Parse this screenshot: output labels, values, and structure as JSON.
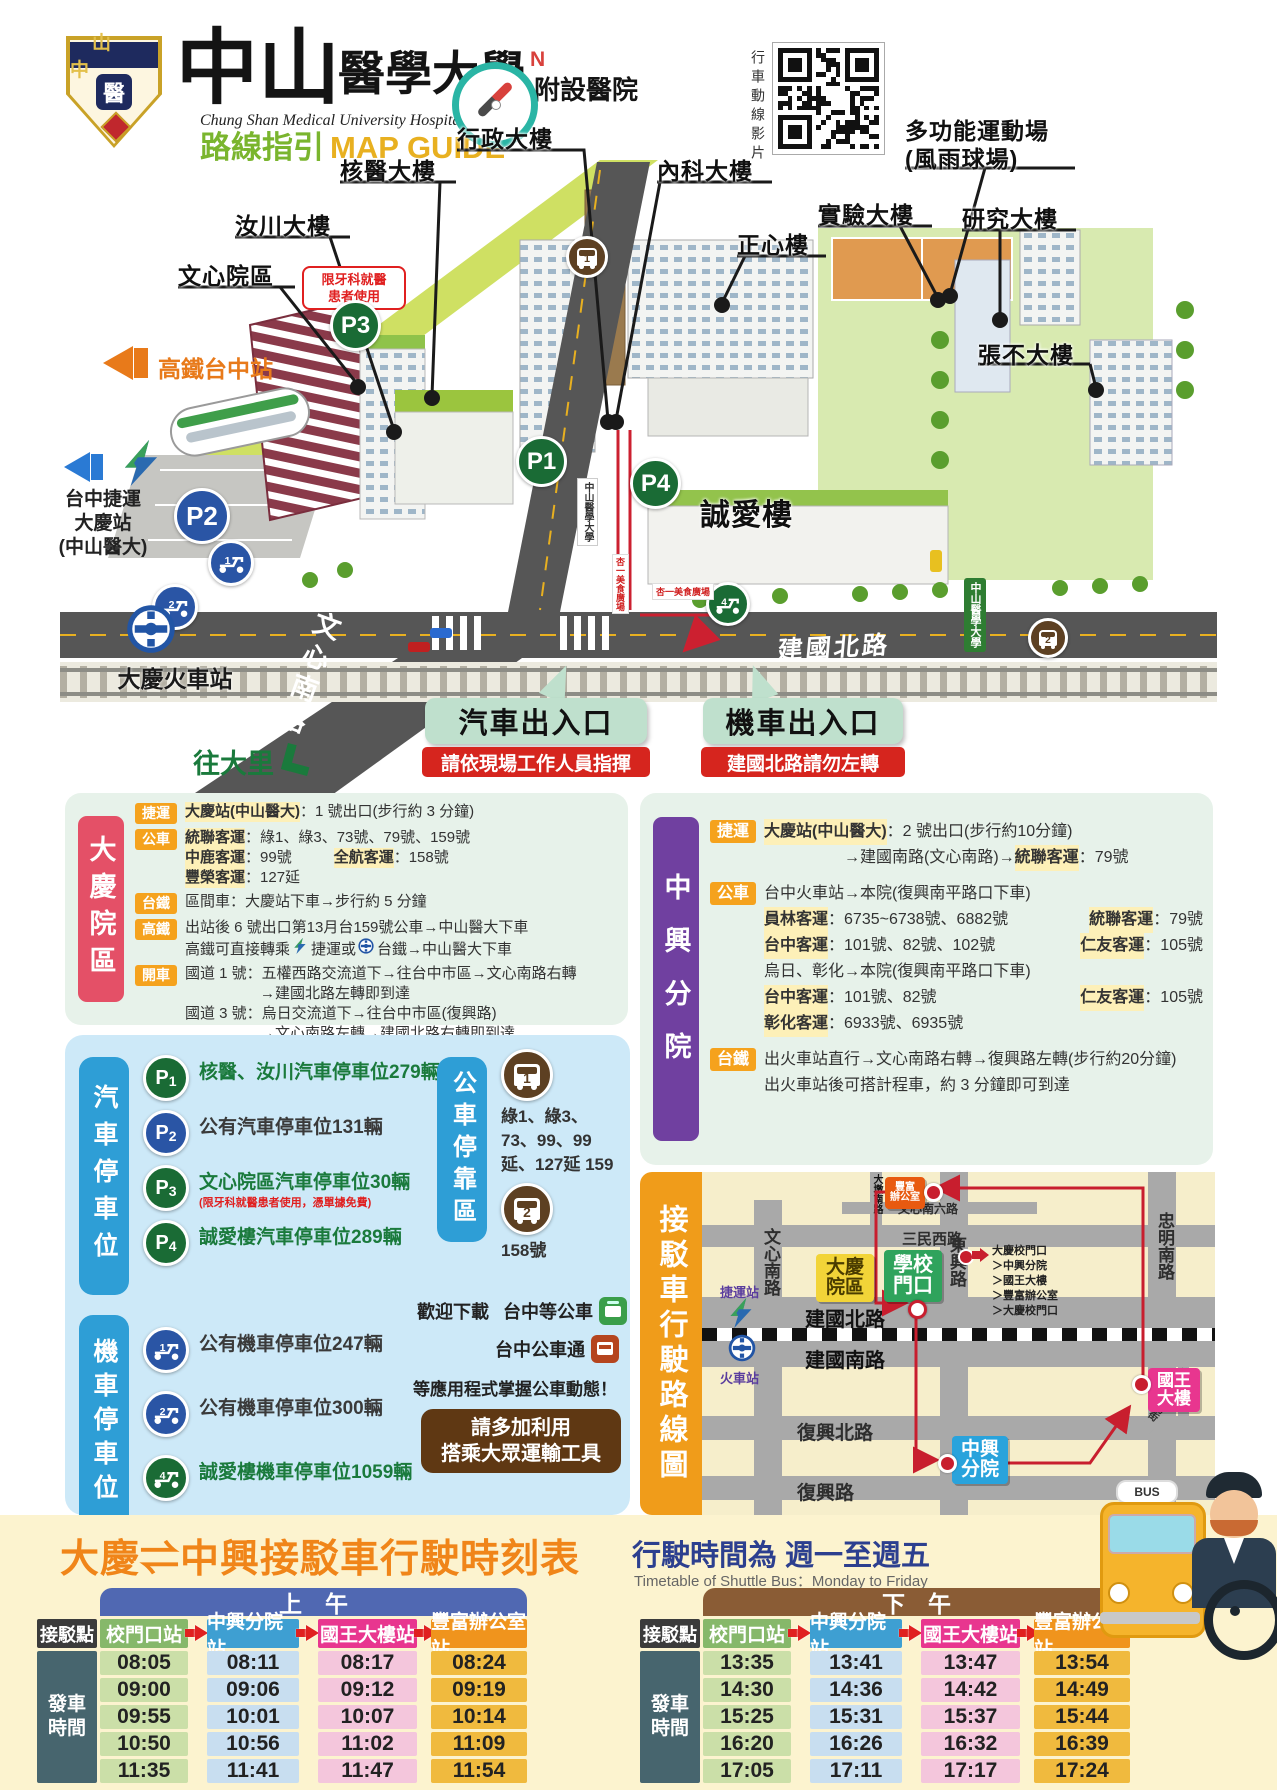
{
  "header": {
    "badge_text": "山中",
    "badge_emblem": "醫",
    "title_zh_main": "中山",
    "title_zh_rest": "醫學大學",
    "title_zh_suffix": "附設醫院",
    "title_en": "Chung Shan Medical University Hospital",
    "guide_zh": "路線指引",
    "guide_en": "MAP GUIDE",
    "compass_n": "N",
    "qr_caption": "行車動線影片"
  },
  "map": {
    "buildings": {
      "admin": "行政大樓",
      "nuclear": "核醫大樓",
      "internal": "內科大樓",
      "zhengxin": "正心樓",
      "lab": "實驗大樓",
      "research": "研究大樓",
      "sports1": "多功能運動場",
      "sports2": "(風雨球場)",
      "zhangbu": "張不大樓",
      "ruchuan": "汝川大樓",
      "wenxin": "文心院區",
      "chengai": "誠愛樓"
    },
    "dental_note1": "限牙科就醫",
    "dental_note2": "患者使用",
    "markers": {
      "p1": "P1",
      "p2": "P2",
      "p3": "P3",
      "p4": "P4",
      "m1": "1",
      "m2": "2",
      "m4": "4",
      "bus1": "1",
      "bus2": "2"
    },
    "hsr_station": "高鐵台中站",
    "mrt_line1": "台中捷運",
    "mrt_line2": "大慶站",
    "mrt_line3": "(中山醫大)",
    "tra_station": "大慶火車站",
    "road_wenxin": "文心南路",
    "road_jianguo": "建國北路",
    "to_dali": "往大里",
    "campus_sign": "中山醫學大學",
    "food_court": "杏一美食廣場",
    "car_entrance": "汽車出入口",
    "car_entrance_note": "請依現場工作人員指揮",
    "moto_entrance": "機車出入口",
    "moto_entrance_note": "建國北路請勿左轉"
  },
  "daqing_box": {
    "title": "大慶院區",
    "rows": [
      {
        "tag": "捷運",
        "lines": [
          [
            {
              "t": "大慶站(中山醫大)",
              "hl": 1
            },
            {
              "t": "：1 號出口(步行約 3 分鐘)"
            }
          ]
        ]
      },
      {
        "tag": "公車",
        "lines": [
          [
            {
              "t": "統聯客運",
              "hl": 1
            },
            {
              "t": "：綠1、綠3、73號、79號、159號"
            }
          ],
          [
            {
              "t": "中鹿客運",
              "hl": 1
            },
            {
              "t": "：99號"
            },
            {
              "t": "全航客運",
              "hl": 1,
              "gap": 1
            },
            {
              "t": "：158號"
            }
          ],
          [
            {
              "t": "豐榮客運",
              "hl": 1
            },
            {
              "t": "：127延"
            }
          ]
        ]
      },
      {
        "tag": "台鐵",
        "lines": [
          [
            {
              "t": "區間車：大慶站下車→步行約 5 分鐘"
            }
          ]
        ]
      },
      {
        "tag": "高鐵",
        "lines": [
          [
            {
              "t": "出站後 6 號出口第13月台159號公車→中山醫大下車"
            }
          ],
          [
            {
              "t": "高鐵可直接轉乘"
            },
            {
              "icon": "mrt"
            },
            {
              "t": "捷運或"
            },
            {
              "icon": "tra"
            },
            {
              "t": "台鐵→中山醫大下車"
            }
          ]
        ]
      },
      {
        "tag": "開車",
        "lines": [
          [
            {
              "t": "國道 1 號：五權西路交流道下→往台中市區→文心南路右轉"
            }
          ],
          [
            {
              "t": "　　　　　→建國北路左轉即到達"
            }
          ],
          [
            {
              "t": "國道 3 號：烏日交流道下→往台中市區(復興路)"
            }
          ],
          [
            {
              "t": "　　　　　→文心南路左轉→建國北路右轉即到達"
            }
          ]
        ]
      }
    ]
  },
  "zhongxing_box": {
    "title": "中興分院",
    "rows": [
      {
        "tag": "捷運",
        "lines": [
          [
            {
              "t": "大慶站(中山醫大)",
              "hl": 1
            },
            {
              "t": "：2 號出口(步行約10分鐘)"
            }
          ],
          [
            {
              "t": "　　　　　→建國南路(文心南路)→"
            },
            {
              "t": "統聯客運",
              "hl": 1
            },
            {
              "t": "：79號"
            }
          ]
        ]
      },
      {
        "tag": "公車",
        "lines": [
          [
            {
              "t": "台中火車站→本院(復興南平路口下車)"
            }
          ],
          [
            {
              "t": "員林客運",
              "hl": 1
            },
            {
              "t": "：6735~6738號、6882號"
            },
            {
              "t": "統聯客運",
              "hl": 1,
              "right": 1
            },
            {
              "t": "：79號"
            }
          ],
          [
            {
              "t": "台中客運",
              "hl": 1
            },
            {
              "t": "：101號、82號、102號"
            },
            {
              "t": "仁友客運",
              "hl": 1,
              "right": 1
            },
            {
              "t": "：105號"
            }
          ],
          [
            {
              "t": "烏日、彰化→本院(復興南平路口下車)"
            }
          ],
          [
            {
              "t": "台中客運",
              "hl": 1
            },
            {
              "t": "：101號、82號"
            },
            {
              "t": "仁友客運",
              "hl": 1,
              "right": 1
            },
            {
              "t": "：105號"
            }
          ],
          [
            {
              "t": "彰化客運",
              "hl": 1
            },
            {
              "t": "：6933號、6935號"
            }
          ]
        ]
      },
      {
        "tag": "台鐵",
        "lines": [
          [
            {
              "t": "出火車站直行→文心南路右轉→復興路左轉(步行約20分鐘)"
            }
          ],
          [
            {
              "t": "出火車站後可搭計程車，約 3 分鐘即可到達"
            }
          ]
        ]
      }
    ]
  },
  "parking": {
    "car_label": "汽車停車位",
    "moto_label": "機車停車位",
    "bus_label": "公車停靠區",
    "car_items": [
      {
        "n": "1",
        "c": "g",
        "t": "核醫、汝川汽車停車位279輛"
      },
      {
        "n": "2",
        "c": "b",
        "t": "公有汽車停車位131輛"
      },
      {
        "n": "3",
        "c": "g",
        "t": "文心院區汽車停車位30輛",
        "note": "(限牙科就醫患者使用，憑單據免費)"
      },
      {
        "n": "4",
        "c": "g",
        "t": "誠愛樓汽車停車位289輛"
      }
    ],
    "moto_items": [
      {
        "n": "1",
        "c": "b",
        "t": "公有機車停車位247輛"
      },
      {
        "n": "2",
        "c": "b",
        "t": "公有機車停車位300輛"
      },
      {
        "n": "4",
        "c": "g",
        "t": "誠愛樓機車停車位1059輛"
      }
    ],
    "bus_stops": [
      {
        "n": "1",
        "routes": "綠1、綠3、73、99、99延、127延 159"
      },
      {
        "n": "2",
        "routes": "158號"
      }
    ],
    "dl_prefix": "歡迎下載",
    "apps": [
      "台中等公車",
      "台中公車通"
    ],
    "dl_suffix": "等應用程式掌握公車動態！",
    "cta1": "請多加利用",
    "cta2": "搭乘大眾運輸工具"
  },
  "shuttle_map": {
    "title": "接駁車行駛路線圖",
    "roads": {
      "wenxin_s": "文心南路",
      "dongxing": "東興路",
      "zhongming_s": "忠明南路",
      "sanmin_w": "三民西路",
      "wenxin_s6": "文心南六路",
      "dadun_s": "大墩南路",
      "jianguo_n": "建國北路",
      "jianguo_s": "建國南路",
      "fuxing_n": "復興北路",
      "fuxing": "復興路",
      "liuchuan_e": "柳川東路",
      "nanyang": "南陽街"
    },
    "stops": {
      "fengfu1": "豐富",
      "fengfu2": "辦公室",
      "daqing1": "大慶",
      "daqing2": "院區",
      "school1": "學校",
      "school2": "門口",
      "king1": "國王",
      "king2": "大樓",
      "zx1": "中興",
      "zx2": "分院"
    },
    "legend": [
      "大慶校門口",
      "中興分院",
      "國王大樓",
      "豐富辦公室",
      "大慶校門口"
    ],
    "mrt": "捷運站",
    "train": "火車站"
  },
  "timetable": {
    "title": "大慶⇌中興接駁車行駛時刻表",
    "schedule_zh": "行駛時間為  週一至週五",
    "schedule_en": "Timetable of Shuttle Bus：Monday to Friday",
    "morning": "上　午",
    "afternoon": "下　午",
    "stop_col": "接駁點",
    "depart1": "發車",
    "depart2": "時間",
    "columns": [
      "校門口站",
      "中興分院站",
      "國王大樓站",
      "豐富辦公室站"
    ],
    "morning_times": [
      [
        "08:05",
        "08:11",
        "08:17",
        "08:24"
      ],
      [
        "09:00",
        "09:06",
        "09:12",
        "09:19"
      ],
      [
        "09:55",
        "10:01",
        "10:07",
        "10:14"
      ],
      [
        "10:50",
        "10:56",
        "11:02",
        "11:09"
      ],
      [
        "11:35",
        "11:41",
        "11:47",
        "11:54"
      ]
    ],
    "afternoon_times": [
      [
        "13:35",
        "13:41",
        "13:47",
        "13:54"
      ],
      [
        "14:30",
        "14:36",
        "14:42",
        "14:49"
      ],
      [
        "15:25",
        "15:31",
        "15:37",
        "15:44"
      ],
      [
        "16:20",
        "16:26",
        "16:32",
        "16:39"
      ],
      [
        "17:05",
        "17:11",
        "17:17",
        "17:24"
      ]
    ],
    "bus_sign": "BUS"
  }
}
